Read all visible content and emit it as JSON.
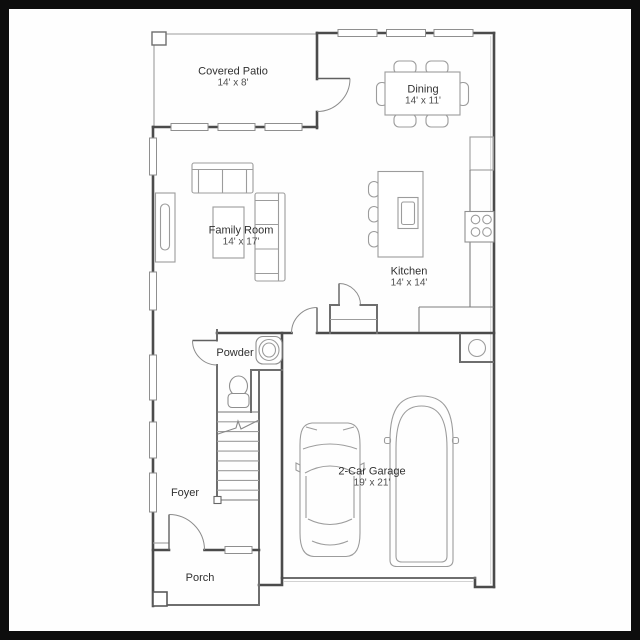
{
  "floorplan": {
    "rooms": [
      {
        "id": "covered-patio",
        "name": "Covered Patio",
        "dimensions": "14' x 8'"
      },
      {
        "id": "dining",
        "name": "Dining",
        "dimensions": "14' x 11'"
      },
      {
        "id": "family-room",
        "name": "Family Room",
        "dimensions": "14' x 17'"
      },
      {
        "id": "kitchen",
        "name": "Kitchen",
        "dimensions": "14' x 14'"
      },
      {
        "id": "powder",
        "name": "Powder",
        "dimensions": ""
      },
      {
        "id": "foyer",
        "name": "Foyer",
        "dimensions": ""
      },
      {
        "id": "garage",
        "name": "2-Car Garage",
        "dimensions": "19' x 21'"
      },
      {
        "id": "porch",
        "name": "Porch",
        "dimensions": ""
      }
    ],
    "colors": {
      "frame": "#0d0d0d",
      "paper": "#fefefe",
      "wall": "#4b4b4b",
      "wall_light": "#6e6e6e",
      "line": "#9c9c9c",
      "door": "#606060",
      "arc": "#8c8c8c",
      "text": "#303030",
      "dim_text": "#4f4f4f"
    }
  }
}
